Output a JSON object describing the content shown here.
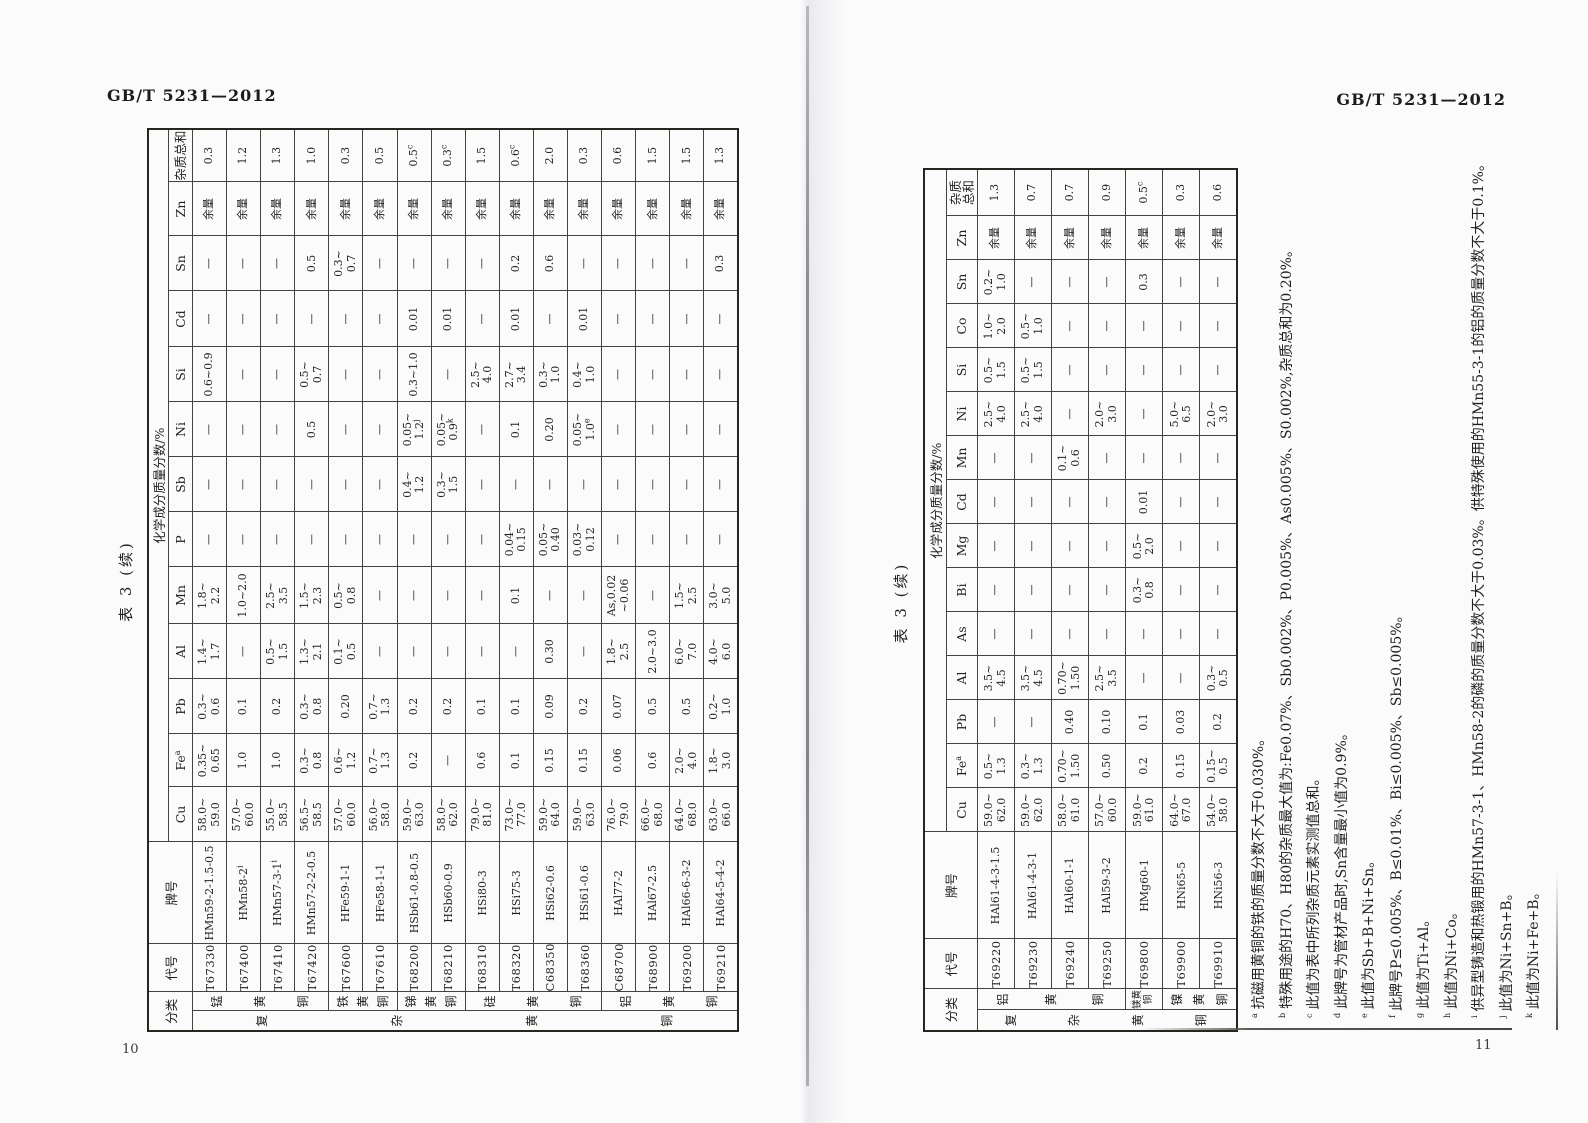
{
  "colors": {
    "paper": "#fbfbfc",
    "ink": "#23221f",
    "grid_line": "#45433e",
    "spine": "#8f8e96"
  },
  "pages": [
    {
      "running_head": "GB/T 5231—2012",
      "page_number": "10",
      "table_title": "表 3 (续)",
      "table": {
        "class_header": "分类",
        "code_header": "代号",
        "name_header": "牌号",
        "span_header": "化学成分质量分数/%",
        "elements": [
          "Cu",
          "Fe^a",
          "Pb",
          "Al",
          "Mn",
          "P",
          "Sb",
          "Ni",
          "Si",
          "Cd",
          "Sn",
          "Zn",
          "杂质总和"
        ],
        "outer_group": {
          "label": "复杂黄铜",
          "rows": 16
        },
        "groups": [
          {
            "label": "锰黄铜",
            "rows": 4
          },
          {
            "label": "铁黄铜",
            "rows": 2
          },
          {
            "label": "锑黄铜",
            "rows": 2
          },
          {
            "label": "硅黄铜",
            "rows": 4
          },
          {
            "label": "铝黄铜",
            "rows": 4
          }
        ],
        "rows": [
          {
            "code": "T67330",
            "name": "HMn59-2-1.5-0.5",
            "values": [
              "58.0~\n59.0",
              "0.35~\n0.65",
              "0.3~\n0.6",
              "1.4~\n1.7",
              "1.8~\n2.2",
              "—",
              "—",
              "—",
              "0.6~0.9",
              "—",
              "—",
              "余量",
              "0.3"
            ]
          },
          {
            "code": "T67400",
            "name": "HMn58-2^i",
            "values": [
              "57.0~\n60.0",
              "1.0",
              "0.1",
              "—",
              "1.0~2.0",
              "—",
              "—",
              "—",
              "—",
              "—",
              "—",
              "余量",
              "1.2"
            ]
          },
          {
            "code": "T67410",
            "name": "HMn57-3-1^i",
            "values": [
              "55.0~\n58.5",
              "1.0",
              "0.2",
              "0.5~\n1.5",
              "2.5~\n3.5",
              "—",
              "—",
              "—",
              "—",
              "—",
              "—",
              "余量",
              "1.3"
            ]
          },
          {
            "code": "T67420",
            "name": "HMn57-2-2-0.5",
            "values": [
              "56.5~\n58.5",
              "0.3~\n0.8",
              "0.3~\n0.8",
              "1.3~\n2.1",
              "1.5~\n2.3",
              "—",
              "—",
              "0.5",
              "0.5~\n0.7",
              "—",
              "0.5",
              "余量",
              "1.0"
            ]
          },
          {
            "code": "T67600",
            "name": "HFe59-1-1",
            "values": [
              "57.0~\n60.0",
              "0.6~\n1.2",
              "0.20",
              "0.1~\n0.5",
              "0.5~\n0.8",
              "—",
              "—",
              "—",
              "—",
              "—",
              "0.3~\n0.7",
              "余量",
              "0.3"
            ]
          },
          {
            "code": "T67610",
            "name": "HFe58-1-1",
            "values": [
              "56.0~\n58.0",
              "0.7~\n1.3",
              "0.7~\n1.3",
              "—",
              "—",
              "—",
              "—",
              "—",
              "—",
              "—",
              "—",
              "余量",
              "0.5"
            ]
          },
          {
            "code": "T68200",
            "name": "HSb61-0.8-0.5",
            "values": [
              "59.0~\n63.0",
              "0.2",
              "0.2",
              "—",
              "—",
              "—",
              "0.4~\n1.2",
              "0.05~\n1.2^j",
              "0.3~1.0",
              "0.01",
              "—",
              "余量",
              "0.5^c"
            ]
          },
          {
            "code": "T68210",
            "name": "HSb60-0.9",
            "values": [
              "58.0~\n62.0",
              "—",
              "0.2",
              "—",
              "—",
              "—",
              "0.3~\n1.5",
              "0.05~\n0.9^k",
              "—",
              "0.01",
              "—",
              "余量",
              "0.3^c"
            ]
          },
          {
            "code": "T68310",
            "name": "HSi80-3",
            "values": [
              "79.0~\n81.0",
              "0.6",
              "0.1",
              "—",
              "—",
              "—",
              "—",
              "—",
              "2.5~\n4.0",
              "—",
              "—",
              "余量",
              "1.5"
            ]
          },
          {
            "code": "T68320",
            "name": "HSi75-3",
            "values": [
              "73.0~\n77.0",
              "0.1",
              "0.1",
              "—",
              "0.1",
              "0.04~\n0.15",
              "—",
              "0.1",
              "2.7~\n3.4",
              "0.01",
              "0.2",
              "余量",
              "0.6^c"
            ]
          },
          {
            "code": "C68350",
            "name": "HSi62-0.6",
            "values": [
              "59.0~\n64.0",
              "0.15",
              "0.09",
              "0.30",
              "—",
              "0.05~\n0.40",
              "—",
              "0.20",
              "0.3~\n1.0",
              "—",
              "0.6",
              "余量",
              "2.0"
            ]
          },
          {
            "code": "T68360",
            "name": "HSi61-0.6",
            "values": [
              "59.0~\n63.0",
              "0.15",
              "0.2",
              "—",
              "—",
              "0.03~\n0.12",
              "—",
              "0.05~\n1.0^e",
              "0.4~\n1.0",
              "0.01",
              "—",
              "余量",
              "0.3"
            ]
          },
          {
            "code": "C68700",
            "name": "HAl77-2",
            "values": [
              "76.0~\n79.0",
              "0.06",
              "0.07",
              "1.8~\n2.5",
              "As,0.02\n~0.06",
              "—",
              "—",
              "—",
              "—",
              "—",
              "—",
              "余量",
              "0.6"
            ]
          },
          {
            "code": "T68900",
            "name": "HAl67-2.5",
            "values": [
              "66.0~\n68.0",
              "0.6",
              "0.5",
              "2.0~3.0",
              "—",
              "—",
              "—",
              "—",
              "—",
              "—",
              "—",
              "余量",
              "1.5"
            ]
          },
          {
            "code": "T69200",
            "name": "HAl66-6-3-2",
            "values": [
              "64.0~\n68.0",
              "2.0~\n4.0",
              "0.5",
              "6.0~\n7.0",
              "1.5~\n2.5",
              "—",
              "—",
              "—",
              "—",
              "—",
              "—",
              "余量",
              "1.5"
            ]
          },
          {
            "code": "T69210",
            "name": "HAl64-5-4-2",
            "values": [
              "63.0~\n66.0",
              "1.8~\n3.0",
              "0.2~\n1.0",
              "4.0~\n6.0",
              "3.0~\n5.0",
              "—",
              "—",
              "—",
              "—",
              "—",
              "0.3",
              "余量",
              "1.3"
            ]
          }
        ]
      }
    },
    {
      "running_head": "GB/T 5231—2012",
      "page_number": "11",
      "table_title": "表 3 (续)",
      "table": {
        "class_header": "分类",
        "code_header": "代号",
        "name_header": "牌号",
        "span_header": "化学成分质量分数/%",
        "elements": [
          "Cu",
          "Fe^a",
          "Pb",
          "Al",
          "As",
          "Bi",
          "Mg",
          "Cd",
          "Mn",
          "Ni",
          "Si",
          "Co",
          "Sn",
          "Zn",
          "杂质\n总和"
        ],
        "outer_group": {
          "label": "复杂黄铜",
          "rows": 7
        },
        "groups": [
          {
            "label": "铝黄铜",
            "rows": 4
          },
          {
            "label": "镁黄铜",
            "rows": 1
          },
          {
            "label": "镍黄铜",
            "rows": 2
          }
        ],
        "rows": [
          {
            "code": "T69220",
            "name": "HAl61-4-3-1.5",
            "values": [
              "59.0~\n62.0",
              "0.5~\n1.3",
              "—",
              "3.5~\n4.5",
              "—",
              "—",
              "—",
              "—",
              "—",
              "2.5~\n4.0",
              "0.5~\n1.5",
              "1.0~\n2.0",
              "0.2~\n1.0",
              "余量",
              "1.3"
            ]
          },
          {
            "code": "T69230",
            "name": "HAl61-4-3-1",
            "values": [
              "59.0~\n62.0",
              "0.3~\n1.3",
              "—",
              "3.5~\n4.5",
              "—",
              "—",
              "—",
              "—",
              "—",
              "2.5~\n4.0",
              "0.5~\n1.5",
              "0.5~\n1.0",
              "—",
              "余量",
              "0.7"
            ]
          },
          {
            "code": "T69240",
            "name": "HAl60-1-1",
            "values": [
              "58.0~\n61.0",
              "0.70~\n1.50",
              "0.40",
              "0.70~\n1.50",
              "—",
              "—",
              "—",
              "—",
              "0.1~\n0.6",
              "—",
              "—",
              "—",
              "—",
              "余量",
              "0.7"
            ]
          },
          {
            "code": "T69250",
            "name": "HAl59-3-2",
            "values": [
              "57.0~\n60.0",
              "0.50",
              "0.10",
              "2.5~\n3.5",
              "—",
              "—",
              "—",
              "—",
              "—",
              "2.0~\n3.0",
              "—",
              "—",
              "—",
              "余量",
              "0.9"
            ]
          },
          {
            "code": "T69800",
            "name": "HMg60-1",
            "values": [
              "59.0~\n61.0",
              "0.2",
              "0.1",
              "—",
              "—",
              "0.3~\n0.8",
              "0.5~\n2.0",
              "0.01",
              "—",
              "—",
              "—",
              "—",
              "0.3",
              "余量",
              "0.5^c"
            ]
          },
          {
            "code": "T69900",
            "name": "HNi65-5",
            "values": [
              "64.0~\n67.0",
              "0.15",
              "0.03",
              "—",
              "—",
              "—",
              "—",
              "—",
              "—",
              "5.0~\n6.5",
              "—",
              "—",
              "—",
              "余量",
              "0.3"
            ]
          },
          {
            "code": "T69910",
            "name": "HNi56-3",
            "values": [
              "54.0~\n58.0",
              "0.15~\n0.5",
              "0.2",
              "0.3~\n0.5",
              "—",
              "—",
              "—",
              "—",
              "—",
              "2.0~\n3.0",
              "—",
              "—",
              "—",
              "余量",
              "0.6"
            ]
          }
        ]
      },
      "footnotes": [
        {
          "mark": "a",
          "text": "抗磁用黄铜的铁的质量分数不大于0.030%。"
        },
        {
          "mark": "b",
          "text": "特殊用途的H70、H80的杂质最大值为:Fe0.07%、Sb0.002%、P0.005%、As0.005%、S0.002%,杂质总和为0.20%。"
        },
        {
          "mark": "c",
          "text": "此值为表中所列杂质元素实测值总和。"
        },
        {
          "mark": "d",
          "text": "此牌号为管材产品时,Sn含量最小值为0.9%。"
        },
        {
          "mark": "e",
          "text": "此值为Sb+B+Ni+Sn。"
        },
        {
          "mark": "f",
          "text": "此牌号P≤0.005%、B≤0.01%、Bi≤0.005%、Sb≤0.005%。"
        },
        {
          "mark": "g",
          "text": "此值为Ti+Al。"
        },
        {
          "mark": "h",
          "text": "此值为Ni+Co。"
        },
        {
          "mark": "i",
          "text": "供异型铸造和热锻用的HMn57-3-1、HMn58-2的磷的质量分数不大于0.03%。供特殊使用的HMn55-3-1的铝的质量分数不大于0.1%。"
        },
        {
          "mark": "j",
          "text": "此值为Ni+Sn+B。"
        },
        {
          "mark": "k",
          "text": "此值为Ni+Fe+B。"
        }
      ]
    }
  ],
  "layout_meta": {
    "left_col_widths": [
      20,
      19,
      48,
      102,
      55,
      53,
      55,
      55,
      57,
      55,
      55,
      55,
      55,
      56,
      55,
      54,
      53
    ],
    "right_col_widths": [
      21,
      21,
      50,
      107,
      44,
      44,
      44,
      44,
      44,
      44,
      44,
      44,
      44,
      44,
      44,
      44,
      44,
      44,
      47
    ],
    "left_header_row_heights": [
      20,
      24
    ],
    "right_header_row_heights": [
      22,
      31
    ],
    "left_body_row_height": 34.25,
    "right_body_row_height": 37.4
  }
}
